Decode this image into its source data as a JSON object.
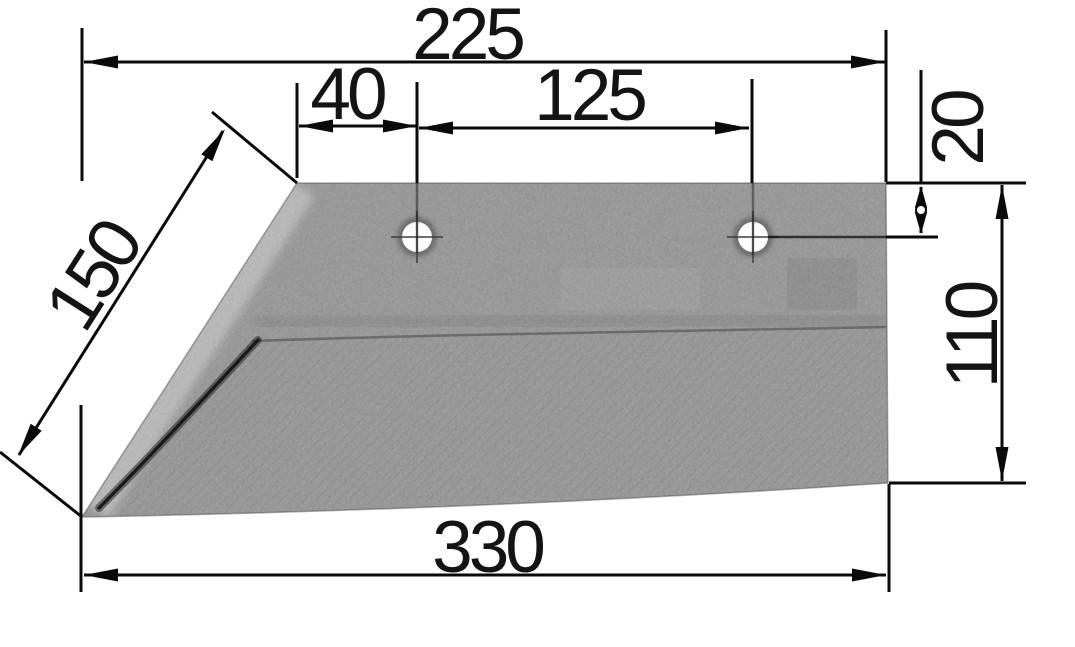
{
  "diagram": {
    "kind": "technical-drawing",
    "dimensions": {
      "top_width": "225",
      "hole_edge_offset": "40",
      "hole_spacing": "125",
      "hole_top_offset": "20",
      "cutting_edge_length": "150",
      "right_height": "110",
      "bottom_width": "330"
    },
    "features": {
      "hole_count": 2
    },
    "colors": {
      "background": "#ffffff",
      "line": "#0a0a0a",
      "text": "#141414",
      "metal_base": "#a5a5a5",
      "metal_average": "#8e8e8e",
      "hole_fill": "#fcfcfc"
    }
  }
}
